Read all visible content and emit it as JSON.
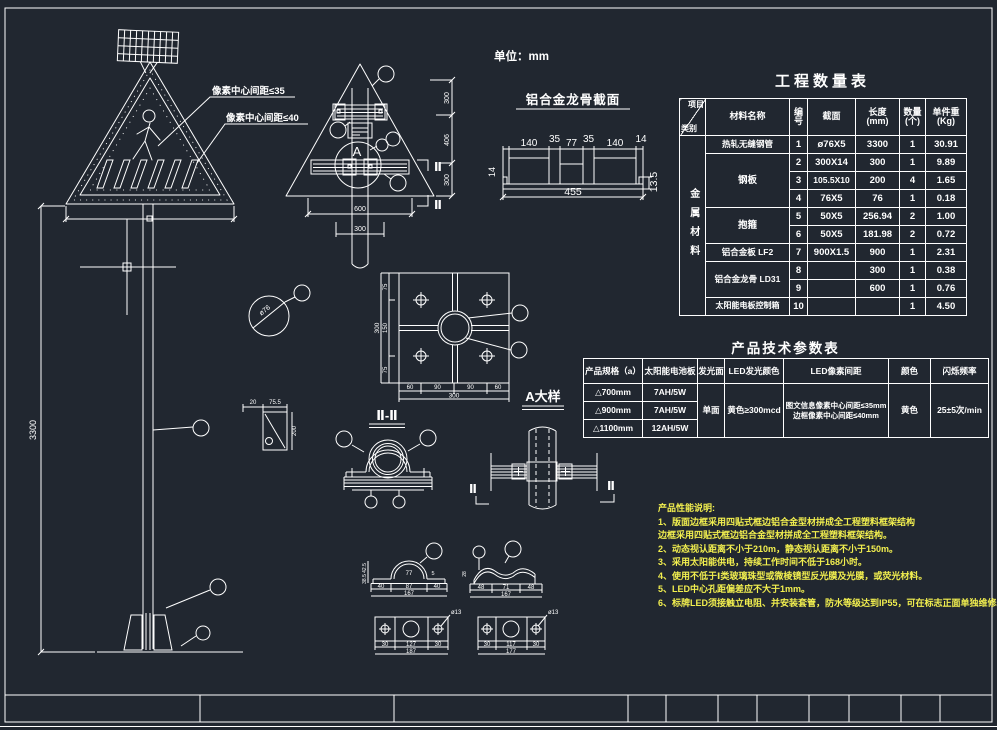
{
  "unit_label": "单位：mm",
  "front_sign": {
    "pitch_label_35": "像素中心间距≤35",
    "pitch_label_40": "像素中心间距≤40",
    "height_dim": "3300"
  },
  "back_sign": {
    "detail_letter": "A",
    "dim_width": "600",
    "dim_pole": "300",
    "dim_right_top": "300",
    "dim_right_mid": "406",
    "dim_right_bot": "300",
    "section_mark": "Ⅱ"
  },
  "keel_profile": {
    "title": "铝合金龙骨截面",
    "top_dims": [
      "140",
      "35",
      "77",
      "35",
      "140",
      "14"
    ],
    "left_dim": "14",
    "bottom_dim": "455",
    "right_dim": "13.5"
  },
  "pipe_section": {
    "label": "ø76"
  },
  "gusset": {
    "dim_a": "20",
    "dim_b": "75.5",
    "dim_h": "200"
  },
  "flange_plate": {
    "bottom_dims": [
      "60",
      "90",
      "90",
      "60"
    ],
    "bottom_total": "300",
    "left_dims": [
      "75",
      "150",
      "75"
    ],
    "left_total": "300",
    "section_label": "Ⅱ-Ⅱ",
    "detail_label": "A大样"
  },
  "saddle": {
    "dims": [
      "77",
      "5",
      "40",
      "87",
      "40",
      "167"
    ],
    "heights": [
      "42.5",
      "38.5"
    ]
  },
  "wave_clamp": {
    "dims": [
      "48",
      "71",
      "48",
      "167"
    ],
    "height": "28"
  },
  "plate_a": {
    "hole": "ø13",
    "dims": [
      "30",
      "127",
      "30"
    ],
    "total": "187"
  },
  "plate_b": {
    "hole": "ø13",
    "dims": [
      "30",
      "117",
      "30"
    ],
    "total": "177"
  },
  "quantity_table": {
    "title": "工程数量表",
    "corner_top": "项目",
    "corner_bottom": "类别",
    "col_material": "材料名称",
    "col_no": "编号",
    "col_section": "截面",
    "col_len1": "长度",
    "col_len2": "(mm)",
    "col_qty1": "数量",
    "col_qty2": "(个)",
    "col_wt1": "单件重",
    "col_wt2": "(Kg)",
    "category": "金属材料",
    "materials": [
      "热轧无缝钢管",
      "钢板",
      "抱箍",
      "铝合金板 LF2",
      "铝合金龙骨 LD31",
      "太阳能电板控制箱"
    ],
    "rows": [
      {
        "no": "1",
        "section": "ø76X5",
        "length": "3300",
        "qty": "1",
        "weight": "30.91"
      },
      {
        "no": "2",
        "section": "300X14",
        "length": "300",
        "qty": "1",
        "weight": "9.89"
      },
      {
        "no": "3",
        "section": "105.5X10",
        "length": "200",
        "qty": "4",
        "weight": "1.65"
      },
      {
        "no": "4",
        "section": "76X5",
        "length": "76",
        "qty": "1",
        "weight": "0.18"
      },
      {
        "no": "5",
        "section": "50X5",
        "length": "256.94",
        "qty": "2",
        "weight": "1.00"
      },
      {
        "no": "6",
        "section": "50X5",
        "length": "181.98",
        "qty": "2",
        "weight": "0.72"
      },
      {
        "no": "7",
        "section": "900X1.5",
        "length": "900",
        "qty": "1",
        "weight": "2.31"
      },
      {
        "no": "8",
        "section": "",
        "length": "300",
        "qty": "1",
        "weight": "0.38"
      },
      {
        "no": "9",
        "section": "",
        "length": "600",
        "qty": "1",
        "weight": "0.76"
      },
      {
        "no": "10",
        "section": "",
        "length": "",
        "qty": "1",
        "weight": "4.50"
      }
    ]
  },
  "param_table": {
    "title": "产品技术参数表",
    "headers": [
      "产品规格（a）",
      "太阳能电池板",
      "发光面",
      "LED发光颜色",
      "LED像素间距",
      "颜色",
      "闪烁频率"
    ],
    "specs": [
      "△700mm",
      "△900mm",
      "△1100mm"
    ],
    "batteries": [
      "7AH/5W",
      "7AH/5W",
      "12AH/5W"
    ],
    "face": "单面",
    "led_color": "黄色≥300mcd",
    "pitch_line1": "图文信息像素中心间距≤35mm",
    "pitch_line2": "边框像素中心间距≤40mm",
    "color": "黄色",
    "blink": "25±5次/min"
  },
  "notes": {
    "title": "产品性能说明:",
    "lines": [
      "1、版面边框采用四贴式框边铝合金型材拼成全工程塑料框架结构",
      "边框采用四贴式框边铝合金型材拼成全工程塑料框架结构。",
      "2、动态视认距离不小于210m，静态视认距离不小于150m。",
      "3、采用太阳能供电，持续工作时间不低于168小时。",
      "4、使用不低于Ⅰ类玻璃珠型或微棱镜型反光膜及光膜，或荧光材料。",
      "5、LED中心孔距偏差应不大于1mm。",
      "6、标牌LED须接触立电阻、并安装套管，防水等级达到IP55，可在标志正面单独维修。"
    ]
  },
  "colors": {
    "background": "#212730",
    "line": "#ffffff",
    "note": "#f2ef4f"
  }
}
